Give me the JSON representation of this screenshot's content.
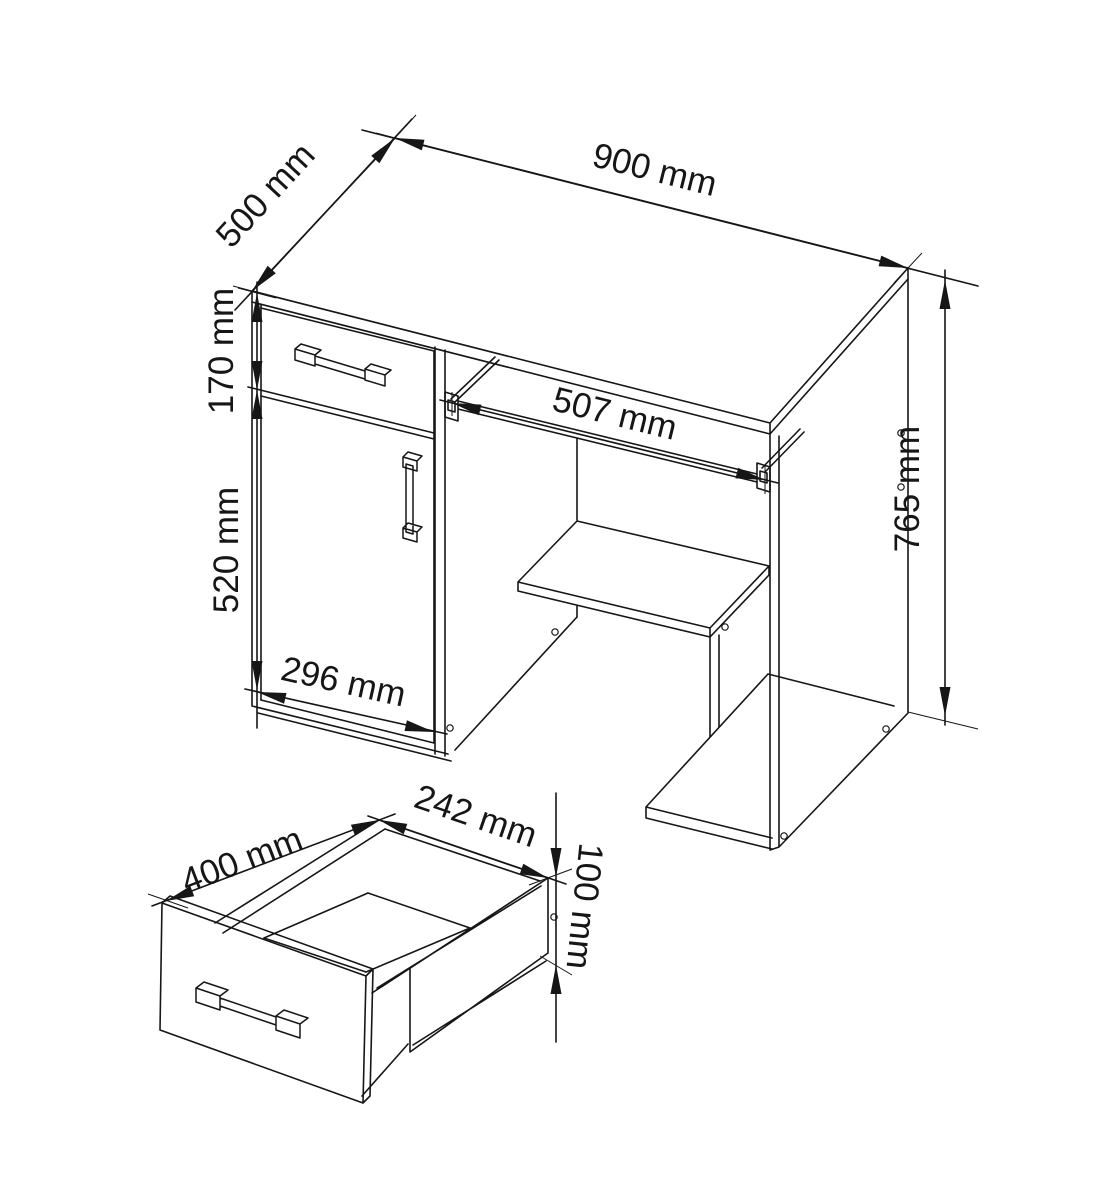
{
  "page": {
    "background_color": "#ffffff",
    "ink_color": "#161616"
  },
  "drawing": {
    "kind": "furniture technical drawing",
    "views": [
      "desk isometric view",
      "drawer detail view"
    ],
    "unit": "mm"
  },
  "dims": {
    "d900": "900 mm",
    "d500": "500 mm",
    "d170": "170 mm",
    "d520": "520 mm",
    "d296": "296 mm",
    "d507": "507 mm",
    "d765": "765 mm",
    "d400": "400 mm",
    "d242": "242 mm",
    "d100": "100 mm"
  }
}
